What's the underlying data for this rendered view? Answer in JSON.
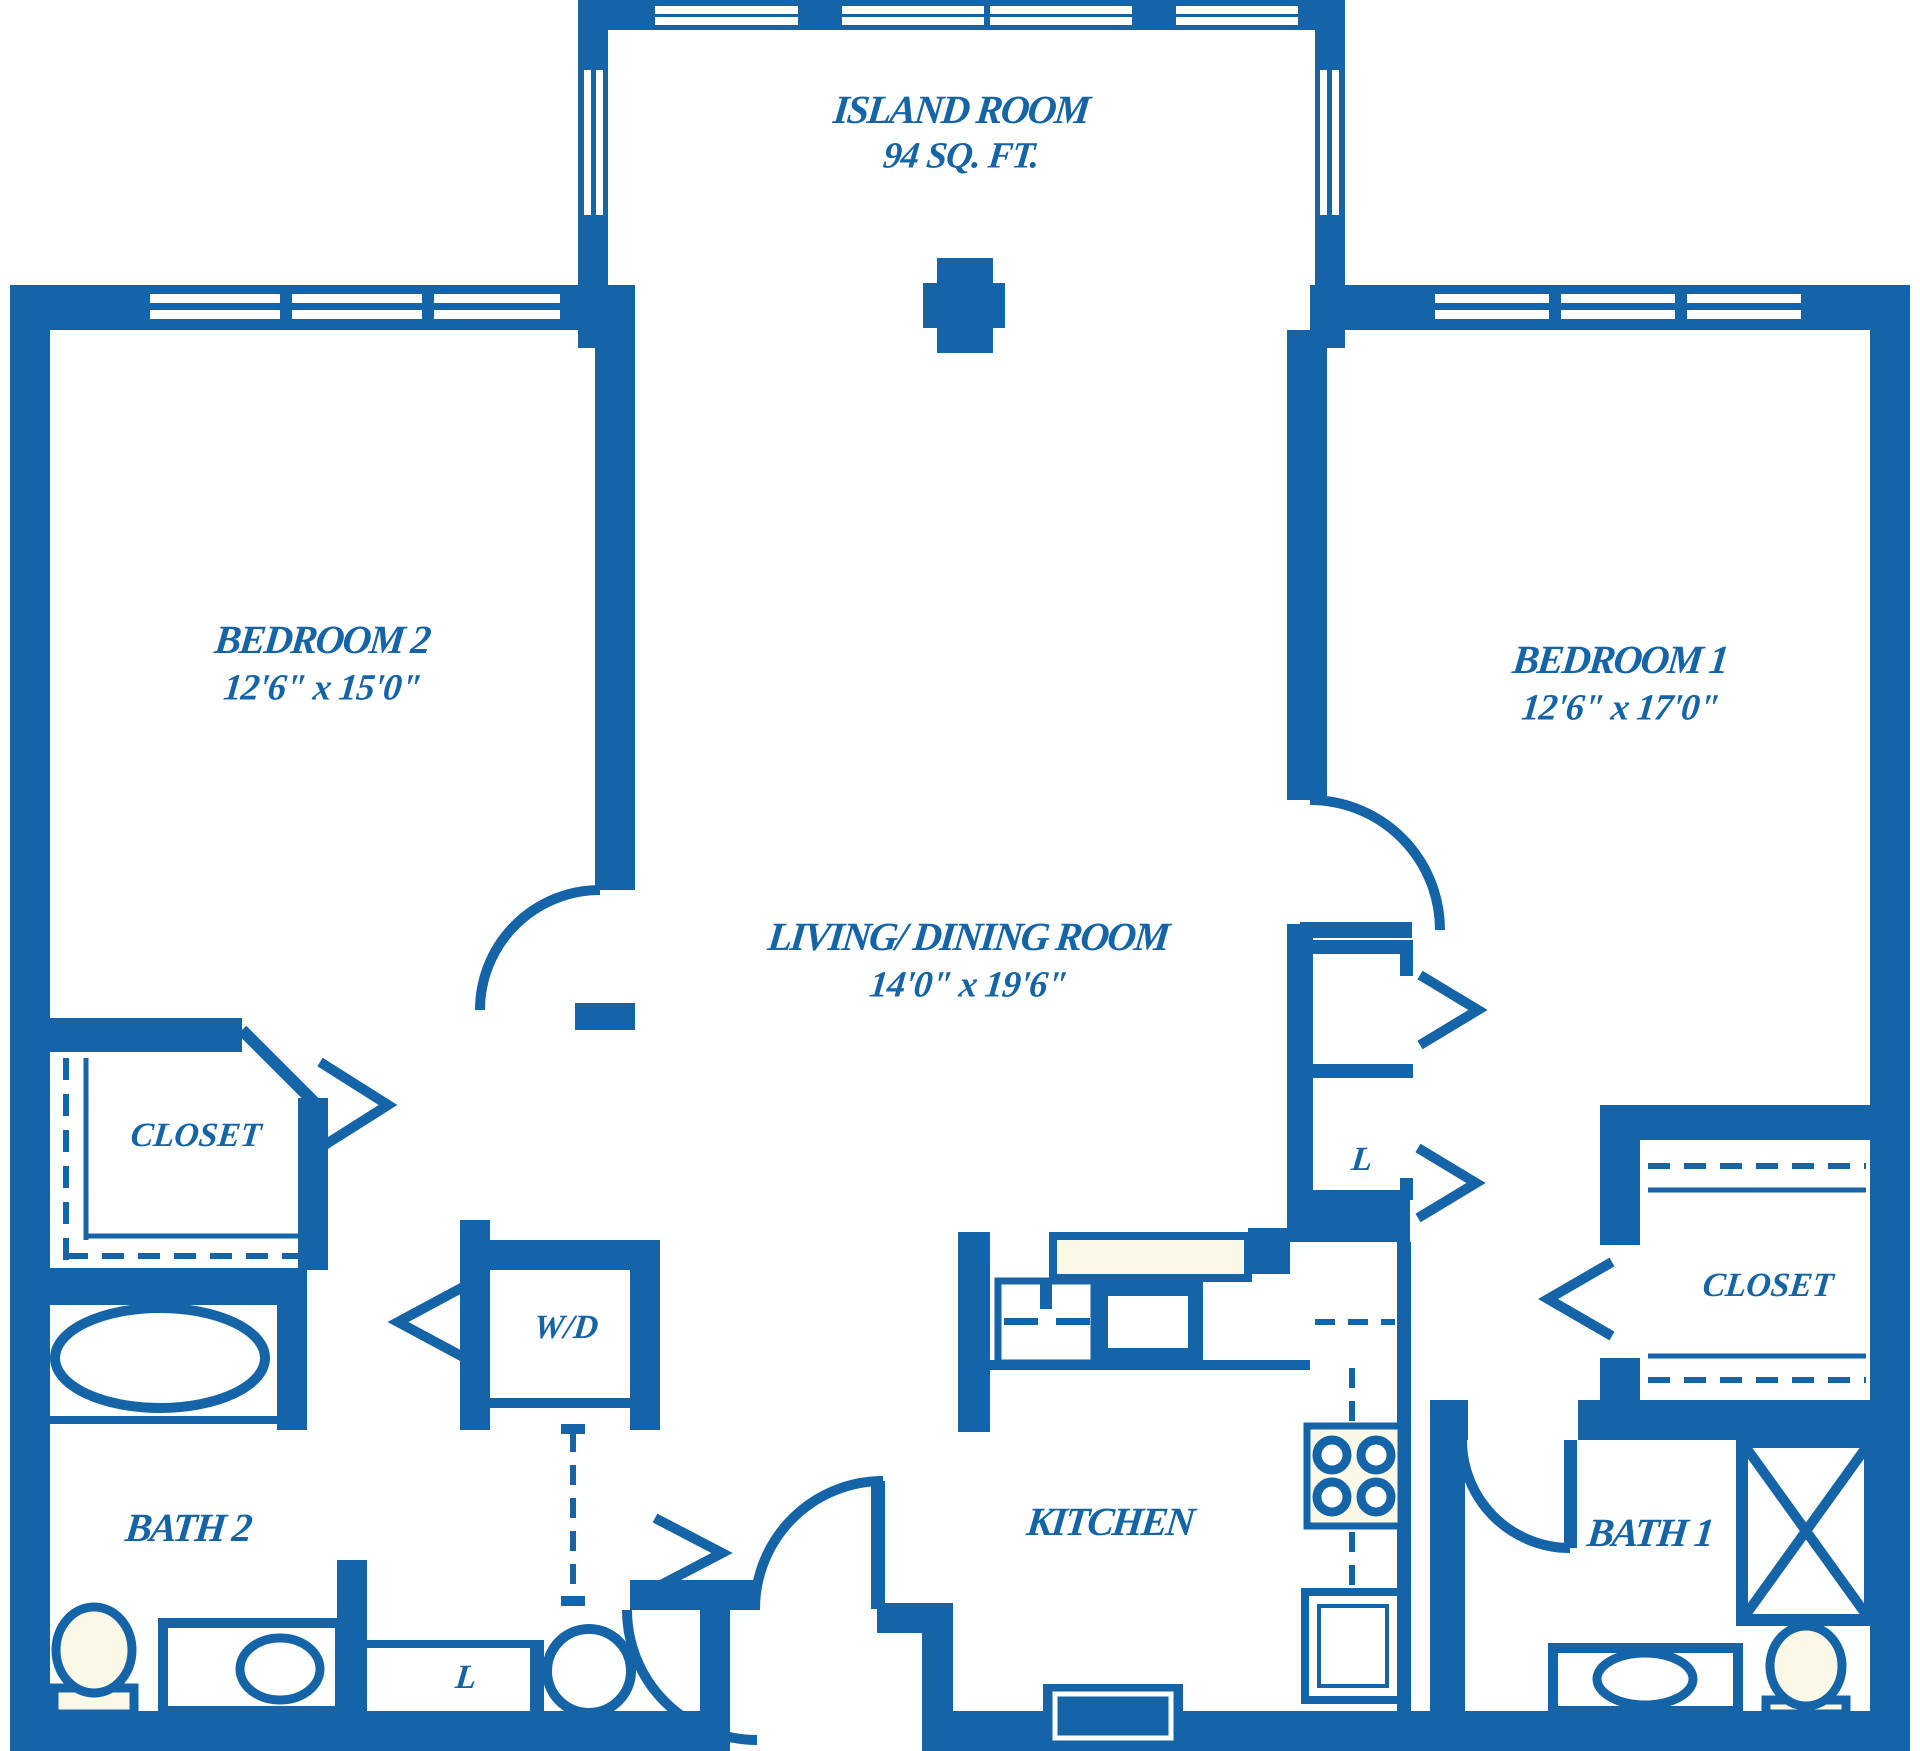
{
  "floor_plan": {
    "colors": {
      "wall_blue": "#1564a8",
      "fixture_cream": "#faf8e6",
      "background": "#ffffff"
    },
    "rooms": {
      "island_room": {
        "name": "ISLAND ROOM",
        "area": "94 SQ. FT."
      },
      "bedroom_2": {
        "name": "BEDROOM 2",
        "dimensions": "12'6\" x 15'0\""
      },
      "bedroom_1": {
        "name": "BEDROOM 1",
        "dimensions": "12'6\" x 17'0\""
      },
      "living_dining": {
        "name": "LIVING/ DINING ROOM",
        "dimensions": "14'0\" x 19'6\""
      },
      "kitchen": {
        "name": "KITCHEN"
      },
      "bath_2": {
        "name": "BATH 2"
      },
      "bath_1": {
        "name": "BATH 1"
      },
      "closet_bedroom_2": {
        "name": "CLOSET"
      },
      "closet_bedroom_1": {
        "name": "CLOSET"
      },
      "washer_dryer": {
        "name": "W/D"
      },
      "linen_hall": {
        "name": "L"
      },
      "linen_bath_2": {
        "name": "L"
      }
    }
  }
}
